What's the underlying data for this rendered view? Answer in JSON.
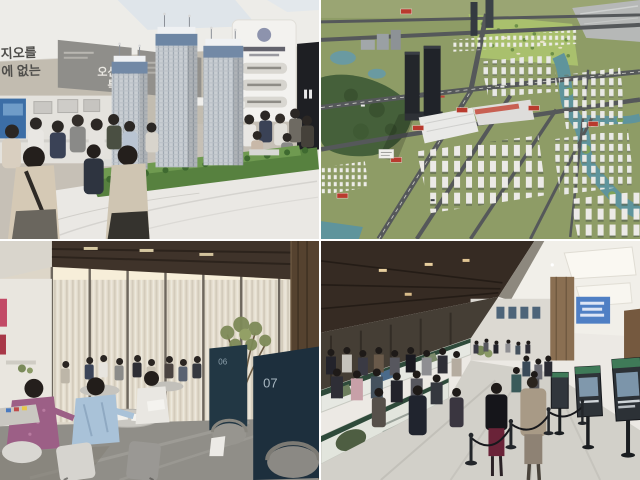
{
  "page": {
    "type": "news-photo-collage",
    "grid": "2x2",
    "divider_color": "#ffffff"
  },
  "photo_top_left": {
    "label": "model-house-apartment-scale-model-with-visitors",
    "wall_headline": {
      "fragment_top": "지오를",
      "fragment_bottom": "에 없는"
    },
    "ocean_view_panel": {
      "line1": "오션뷰",
      "line2": "특권"
    },
    "tower_count": 3
  },
  "photo_top_right": {
    "label": "city-masterplan-diorama-aerial",
    "road_sign_color": "#b93a2e"
  },
  "photo_bottom_left": {
    "label": "consultation-lounge-tables",
    "booths": [
      {
        "number": "06"
      },
      {
        "number": "07"
      }
    ]
  },
  "photo_bottom_right": {
    "label": "crowded-sales-exhibition-hall"
  },
  "palette": {
    "divider": "#ffffff",
    "tl_wall": "#c6c0b6",
    "tl_panel_gray": "#8f8e8a",
    "tl_tower": "#c9ced3",
    "tl_tower_crown": "#7289a6",
    "tl_marble": "#eae8e4",
    "tl_tree_green": "#4c7a3e",
    "tr_grass": "#8e9c66",
    "tr_forest": "#45603a",
    "tr_water": "#5f949c",
    "tr_road": "#55585a",
    "tr_dark_tower": "#23262b",
    "tr_golf": "#a9c06d",
    "bl_ceiling_wood": "#3f332a",
    "bl_curtain": "#e6dfd0",
    "bl_booth_teal": "#203140",
    "bl_floor": "#908e88",
    "bl_shirt_blue": "#a9c2d8",
    "bl_top_purple": "#9c5f86",
    "br_ceiling_dark": "#362b23",
    "br_ceiling_light": "#f1efe9",
    "br_floor": "#d2d0c9",
    "br_board_green": "#2e4a3a",
    "br_banner_blue": "#4f7fc4",
    "br_stand_dark": "#2c3136"
  }
}
